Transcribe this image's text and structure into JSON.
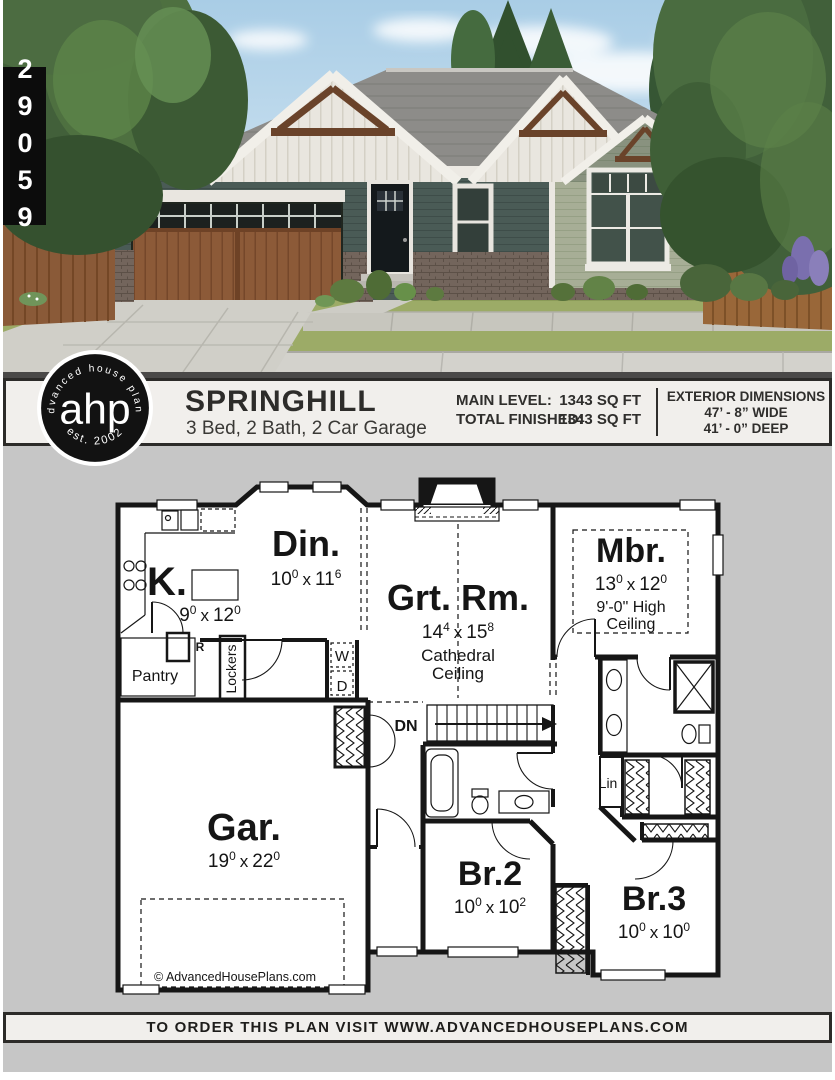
{
  "plan_number": "29059",
  "logo": {
    "abbr": "ahp",
    "arc_top": "advanced house plans",
    "arc_bottom": "est. 2002"
  },
  "header": {
    "title": "SPRINGHILL",
    "subtitle": "3 Bed, 2 Bath, 2 Car Garage",
    "stats": [
      {
        "label": "MAIN LEVEL:",
        "value": "1343 SQ FT"
      },
      {
        "label": "TOTAL FINISHED:",
        "value": "1343 SQ FT"
      }
    ],
    "dimensions": {
      "heading": "EXTERIOR DIMENSIONS",
      "width": "47’ - 8” WIDE",
      "depth": "41’ - 0” DEEP"
    }
  },
  "floor_plan": {
    "rooms": {
      "kitchen": {
        "label": "K.",
        "dim": {
          "a": "9",
          "asup": "0",
          "x": "x",
          "b": "12",
          "bsup": "0"
        }
      },
      "dining": {
        "label": "Din.",
        "dim": {
          "a": "10",
          "asup": "0",
          "x": "x",
          "b": "11",
          "bsup": "6"
        }
      },
      "great_room": {
        "label": "Grt. Rm.",
        "dim": {
          "a": "14",
          "asup": "4",
          "x": "x",
          "b": "15",
          "bsup": "8"
        },
        "note_line1": "Cathedral",
        "note_line2": "Ceiling"
      },
      "master": {
        "label": "Mbr.",
        "dim": {
          "a": "13",
          "asup": "0",
          "x": "x",
          "b": "12",
          "bsup": "0"
        },
        "note_line1": "9'-0\" High",
        "note_line2": "Ceiling"
      },
      "garage": {
        "label": "Gar.",
        "dim": {
          "a": "19",
          "asup": "0",
          "x": "x",
          "b": "22",
          "bsup": "0"
        }
      },
      "bedroom2": {
        "label": "Br.2",
        "dim": {
          "a": "10",
          "asup": "0",
          "x": "x",
          "b": "10",
          "bsup": "2"
        }
      },
      "bedroom3": {
        "label": "Br.3",
        "dim": {
          "a": "10",
          "asup": "0",
          "x": "x",
          "b": "10",
          "bsup": "0"
        }
      },
      "pantry": "Pantry",
      "lockers": "Lockers",
      "fridge": "R",
      "washer": "W",
      "dryer": "D",
      "stairs_down": "DN",
      "linen": "Lin"
    },
    "copyright": "© AdvancedHousePlans.com"
  },
  "footer": {
    "text": "TO ORDER THIS PLAN VISIT WWW.ADVANCEDHOUSEPLANS.COM"
  },
  "colors": {
    "page_gray": "#c6c6c6",
    "panel_bg": "#f1efec",
    "panel_border": "#2c2b29",
    "tag_black": "#0c0c0c",
    "siding_sage": "#a7ae96",
    "siding_teal": "#4a5b56",
    "garage_wood": "#8c5a38",
    "roof_gray": "#8d8c89",
    "lawn_green": "#9cab67"
  }
}
